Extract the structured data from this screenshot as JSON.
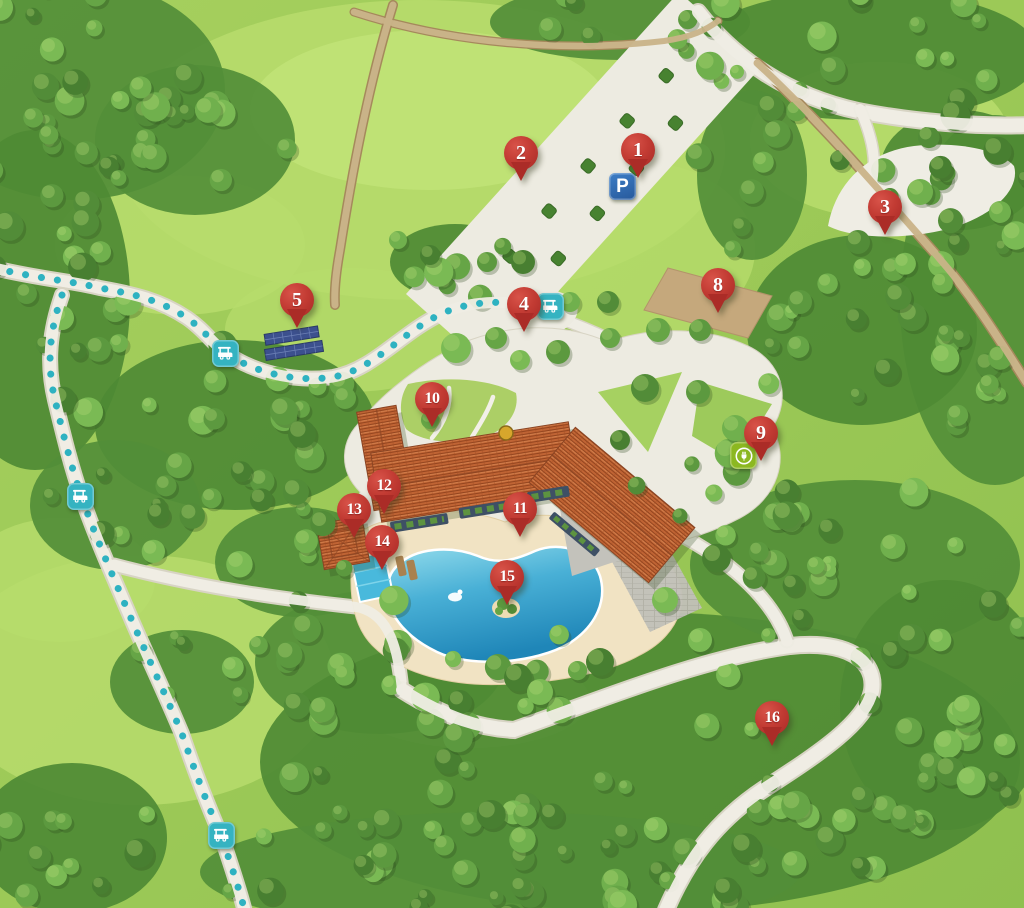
{
  "map": {
    "name": "illustrated-resort-map",
    "width": 1024,
    "height": 908
  },
  "colors": {
    "pin_red": "#b93530",
    "trail_teal": "#2eb2c1",
    "parking_blue": "#2f6cb3",
    "ev_green": "#8cb821",
    "pool_blue": "#2f9dca",
    "roof_terracotta": "#bf6434",
    "grass_green": "#9cc957",
    "forest_green": "#4c8733",
    "sand": "#f1e3c3",
    "solar_panel_blue": "#3c508e"
  },
  "markers": [
    {
      "label": "1",
      "x": 638,
      "y": 150
    },
    {
      "label": "2",
      "x": 521,
      "y": 153
    },
    {
      "label": "3",
      "x": 885,
      "y": 207
    },
    {
      "label": "4",
      "x": 524,
      "y": 304
    },
    {
      "label": "5",
      "x": 297,
      "y": 300
    },
    {
      "label": "8",
      "x": 718,
      "y": 285
    },
    {
      "label": "9",
      "x": 761,
      "y": 433
    },
    {
      "label": "10",
      "x": 432,
      "y": 399
    },
    {
      "label": "11",
      "x": 520,
      "y": 509
    },
    {
      "label": "12",
      "x": 384,
      "y": 486
    },
    {
      "label": "13",
      "x": 354,
      "y": 510
    },
    {
      "label": "14",
      "x": 382,
      "y": 542
    },
    {
      "label": "15",
      "x": 507,
      "y": 577
    },
    {
      "label": "16",
      "x": 772,
      "y": 718
    }
  ],
  "icons": {
    "parking_sign": {
      "glyph": "P",
      "x": 622,
      "y": 186
    },
    "ev_charging_station": {
      "x": 743,
      "y": 455
    },
    "golf_cart_stations": [
      {
        "x": 550,
        "y": 306
      },
      {
        "x": 225,
        "y": 353
      },
      {
        "x": 80,
        "y": 496
      },
      {
        "x": 221,
        "y": 835
      }
    ]
  }
}
